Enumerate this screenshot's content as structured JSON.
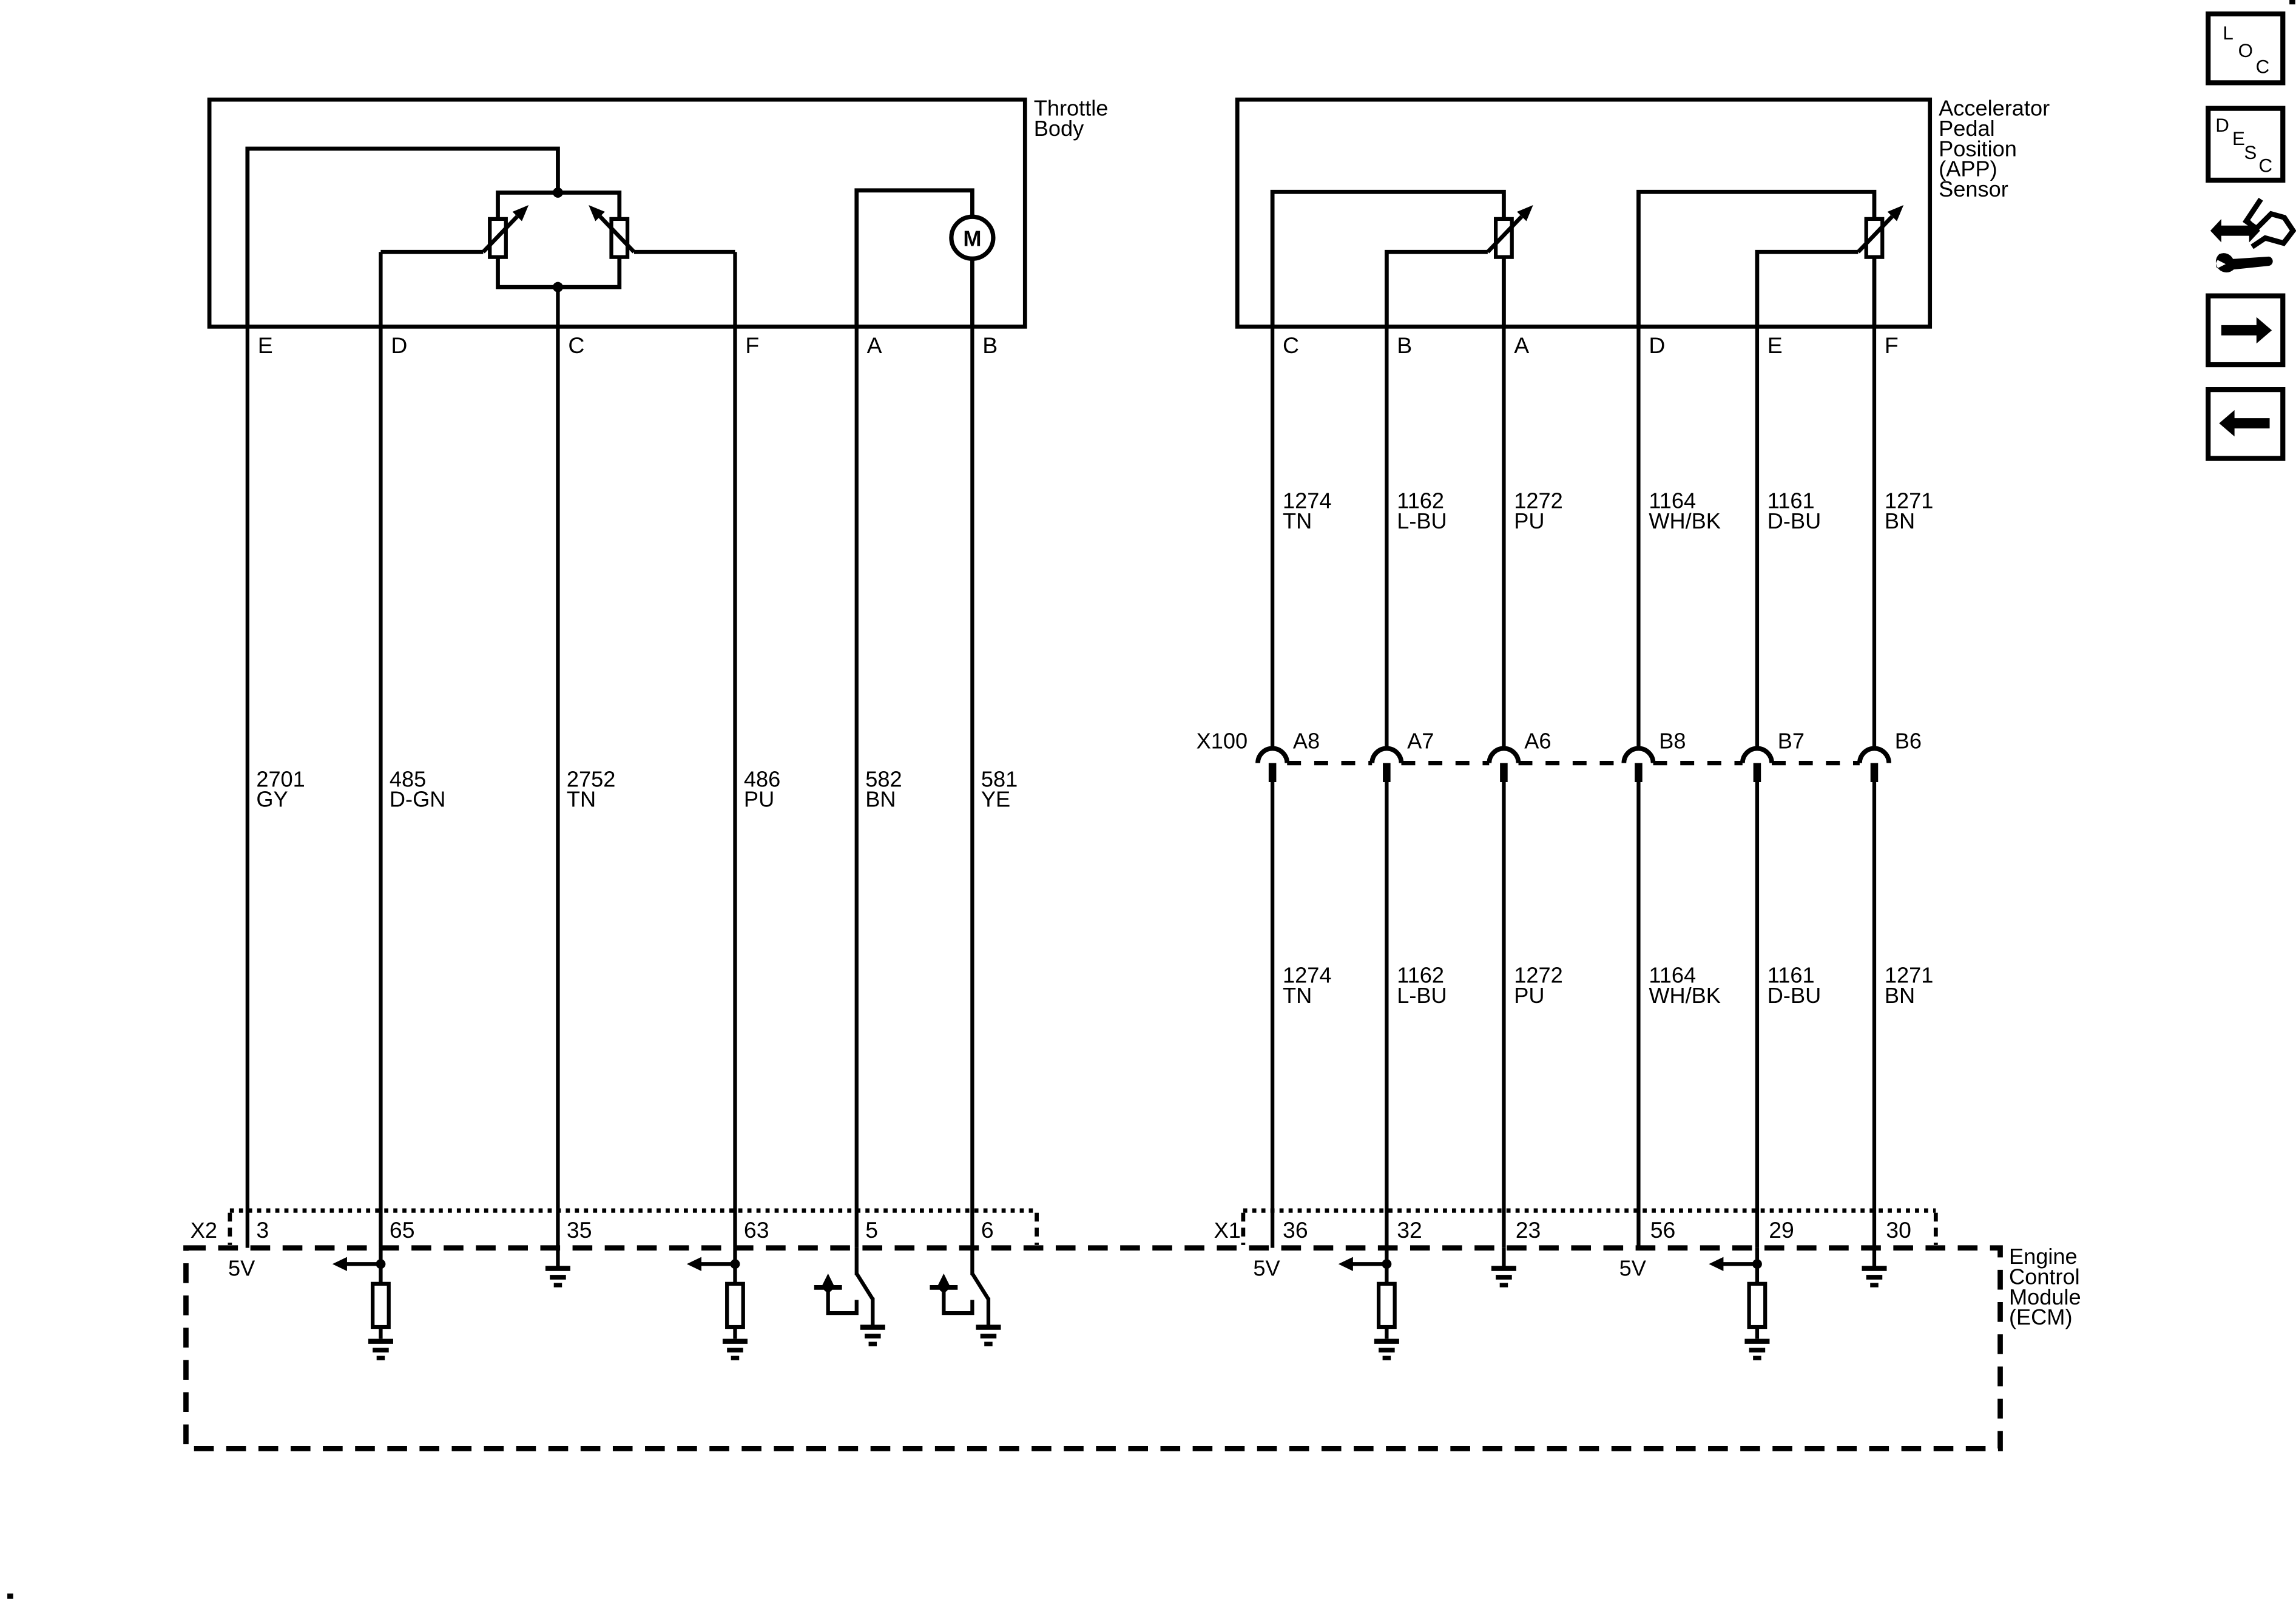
{
  "throttle": {
    "label_lines": [
      "Throttle",
      "Body"
    ],
    "pins": [
      "E",
      "D",
      "C",
      "F",
      "A",
      "B"
    ],
    "motor": "M"
  },
  "app": {
    "label_lines": [
      "Accelerator",
      "Pedal",
      "Position",
      "(APP)",
      "Sensor"
    ],
    "pins": [
      "C",
      "B",
      "A",
      "D",
      "E",
      "F"
    ]
  },
  "left_wires": [
    {
      "pin": "E",
      "circuit": "2701",
      "color": "GY",
      "ecm_pin": "3"
    },
    {
      "pin": "D",
      "circuit": "485",
      "color": "D-GN",
      "ecm_pin": "65"
    },
    {
      "pin": "C",
      "circuit": "2752",
      "color": "TN",
      "ecm_pin": "35"
    },
    {
      "pin": "F",
      "circuit": "486",
      "color": "PU",
      "ecm_pin": "63"
    },
    {
      "pin": "A",
      "circuit": "582",
      "color": "BN",
      "ecm_pin": "5"
    },
    {
      "pin": "B",
      "circuit": "581",
      "color": "YE",
      "ecm_pin": "6"
    }
  ],
  "right_wires": [
    {
      "pin": "C",
      "circuit": "1274",
      "color": "TN",
      "x100_pin": "A8",
      "ecm_pin": "36"
    },
    {
      "pin": "B",
      "circuit": "1162",
      "color": "L-BU",
      "x100_pin": "A7",
      "ecm_pin": "32"
    },
    {
      "pin": "A",
      "circuit": "1272",
      "color": "PU",
      "x100_pin": "A6",
      "ecm_pin": "23"
    },
    {
      "pin": "D",
      "circuit": "1164",
      "color": "WH/BK",
      "x100_pin": "B8",
      "ecm_pin": "56"
    },
    {
      "pin": "E",
      "circuit": "1161",
      "color": "D-BU",
      "x100_pin": "B7",
      "ecm_pin": "29"
    },
    {
      "pin": "F",
      "circuit": "1271",
      "color": "BN",
      "x100_pin": "B6",
      "ecm_pin": "30"
    }
  ],
  "connectors": {
    "x100": "X100",
    "x2": "X2",
    "x1": "X1"
  },
  "ecm": {
    "label_lines": [
      "Engine",
      "Control",
      "Module",
      "(ECM)"
    ],
    "supply_label": "5V"
  },
  "nav_icons": {
    "loc_letters": [
      "L",
      "O",
      "C"
    ],
    "desc_letters": [
      "D",
      "E",
      "S",
      "C"
    ]
  },
  "colors": {
    "line": "#000000",
    "background": "#ffffff"
  }
}
